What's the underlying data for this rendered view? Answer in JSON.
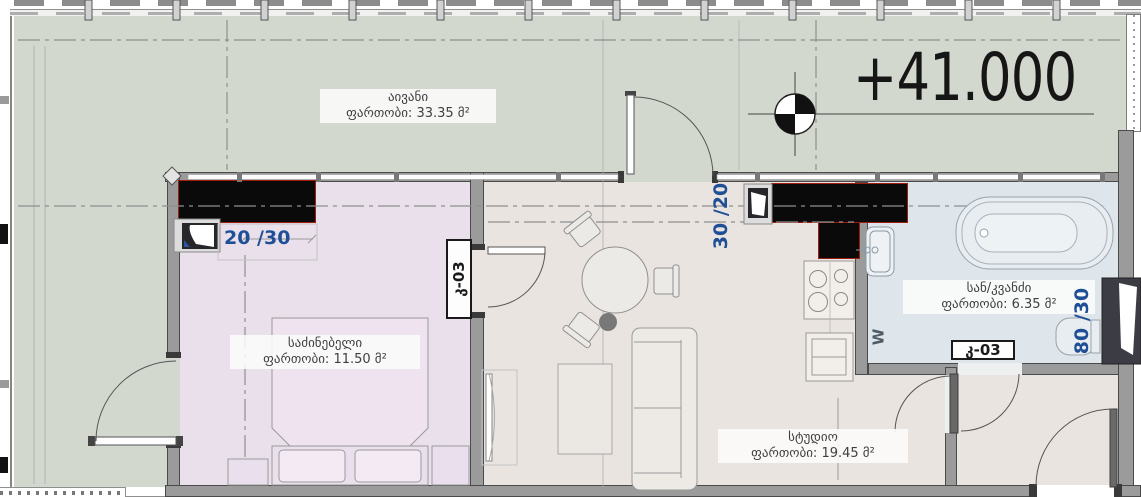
{
  "plan": {
    "elevation_label": "+41.000",
    "rooms": [
      {
        "id": "balcony",
        "name": "აივანი",
        "area": "ფართობი: 33.35 მ²",
        "floor_color": "#d3d8cf"
      },
      {
        "id": "bedroom",
        "name": "საძინებელი",
        "area": "ფართობი: 11.50 მ²",
        "floor_color": "#eae0ec"
      },
      {
        "id": "studio",
        "name": "სტუდიო",
        "area": "ფართობი: 19.45 მ²",
        "floor_color": "#e9e4e0"
      },
      {
        "id": "bathroom",
        "name": "სან/კვანძი",
        "area": "ფართობი: 6.35 მ²",
        "floor_color": "#dfe6eb"
      }
    ],
    "door_tags": [
      {
        "id": "bedroom-door",
        "label": "კ-03"
      },
      {
        "id": "bathroom-door",
        "label": "კ-03"
      }
    ],
    "dimensions": [
      {
        "id": "bedroom-window",
        "label": "20 /30"
      },
      {
        "id": "studio-window",
        "label": "30 /20"
      },
      {
        "id": "bathroom-duct",
        "label": "80 /30"
      }
    ],
    "appliances": {
      "washer_label": "W"
    },
    "colors": {
      "dimension_text": "#1f4f96",
      "accent_red": "#a11b0f",
      "wall": "#9b9b9b",
      "counter_black": "#0a0a0a"
    }
  }
}
